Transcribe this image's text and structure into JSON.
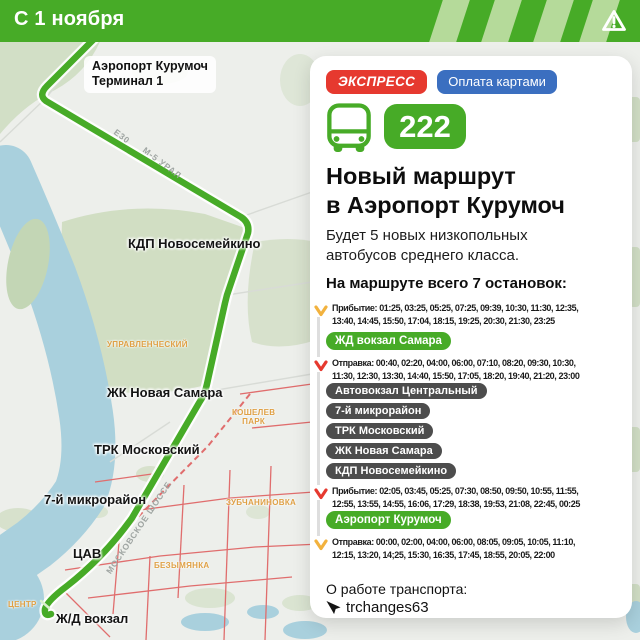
{
  "header": {
    "title": "С 1 ноября"
  },
  "map": {
    "stops": {
      "airport_line1": "Аэропорт Курумоч",
      "airport_line2": "Терминал 1",
      "kdp": "КДП Новосемейкино",
      "zhk": "ЖК Новая Самара",
      "trk": "ТРК Московский",
      "mkr": "7-й микрорайон",
      "cav": "ЦАВ",
      "rail": "Ж/Д вокзал"
    },
    "districts": {
      "upravlencheskiy": "УПРАВЛЕНЧЕСКИЙ",
      "koshelev_line1": "КОШЕЛЕВ",
      "koshelev_line2": "ПАРК",
      "zubchaninovka": "ЗУБЧАНИНОВКА",
      "bezymyanka": "БЕЗЫМЯНКА",
      "centr": "ЦЕНТР"
    },
    "roads": {
      "e30": "E30",
      "m5": "М-5 УРАЛ",
      "moskovskoe": "МОСКОВСКОЕ ШОССЕ"
    }
  },
  "card": {
    "badges": {
      "express": "ЭКСПРЕСС",
      "payment": "Оплата картами"
    },
    "route_number": "222",
    "title_line1": "Новый маршрут",
    "title_line2": "в Аэропорт Курумоч",
    "description": "Будет 5 новых низкопольных автобусов среднего класса.",
    "stops_heading": "На маршруте всего 7 остановок:",
    "schedule": {
      "arrival_to_samara": "Прибытие: 01:25, 03:25, 05:25, 07:25, 09:39, 10:30, 11:30, 12:35, 13:40, 14:45, 15:50, 17:04, 18:15, 19:25, 20:30, 21:30, 23:25",
      "terminal_samara": "ЖД вокзал Самара",
      "departure_from_samara": "Отправка: 00:40, 02:20, 04:00, 06:00, 07:10, 08:20, 09:30, 10:30, 11:30, 12:30, 13:30, 14:40, 15:50, 17:05, 18:20, 19:40, 21:20, 23:00",
      "intermediate_stops": [
        "Автовокзал Центральный",
        "7-й микрорайон",
        "ТРК Московский",
        "ЖК Новая Самара",
        "КДП Новосемейкино"
      ],
      "arrival_to_airport": "Прибытие: 02:05, 03:45, 05:25, 07:30, 08:50, 09:50, 10:55, 11:55, 12:55, 13:55, 14:55, 16:06, 17:29, 18:38, 19:53, 21:08, 22:45, 00:25",
      "terminal_airport": "Аэропорт Курумоч",
      "departure_from_airport": "Отправка: 00:00, 02:00, 04:00, 06:00, 08:05, 09:05, 10:05, 11:10, 12:15, 13:20, 14;25, 15:30, 16:35, 17:45, 18:55, 20:05, 22:00"
    },
    "footer": {
      "label": "О работе транспорта:",
      "channel": "trchanges63"
    }
  },
  "colors": {
    "green": "#47ab27",
    "light_green_stripe": "#b5da9a",
    "red": "#e6392f",
    "blue": "#3b6fc0",
    "yellow_arrow": "#f2b23e",
    "dark_pill": "#4d4d4d",
    "river": "#a9d0dd",
    "forest": "#cddcbf",
    "orange_label": "#dfa045"
  }
}
